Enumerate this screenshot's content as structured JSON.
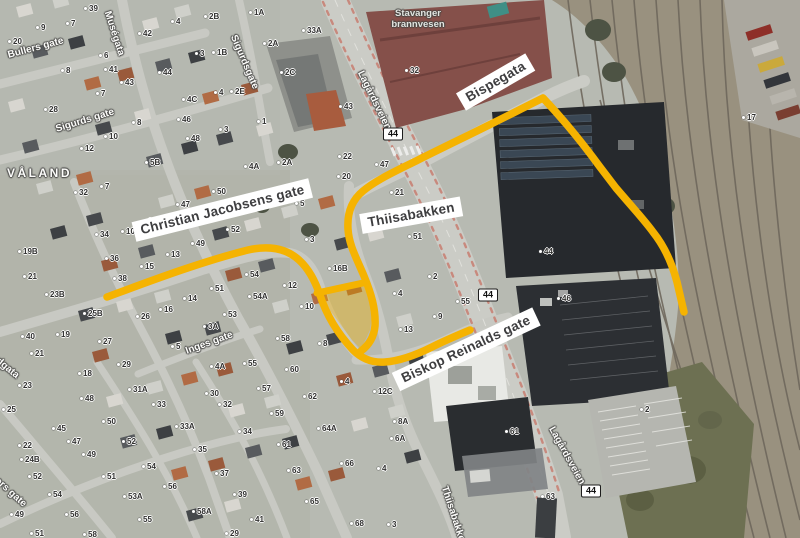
{
  "map": {
    "route_highlight_color": "#F5B301",
    "poi": {
      "line1": "Stavanger",
      "line2": "brannvesen"
    },
    "annotation_boxes": [
      {
        "text": "Christian Jacobsens gate",
        "x": 134,
        "y": 222,
        "rot": -14
      },
      {
        "text": "Thiisabakken",
        "x": 361,
        "y": 214,
        "rot": -10
      },
      {
        "text": "Bispegata",
        "x": 461,
        "y": 92,
        "rot": -30
      },
      {
        "text": "Biskop Reinalds gate",
        "x": 396,
        "y": 372,
        "rot": -25
      }
    ],
    "road_number_badges": [
      {
        "label": "44",
        "x": 393,
        "y": 134
      },
      {
        "label": "44",
        "x": 488,
        "y": 295
      },
      {
        "label": "44",
        "x": 591,
        "y": 491
      }
    ],
    "street_labels": [
      {
        "text": "Bullers gate",
        "x": 8,
        "y": 50,
        "rot": -15,
        "size": 10
      },
      {
        "text": "Muségata",
        "x": 107,
        "y": 6,
        "rot": 72,
        "size": 10
      },
      {
        "text": "Sigurdsgate",
        "x": 233,
        "y": 30,
        "rot": 67,
        "size": 10
      },
      {
        "text": "Sigurds gate",
        "x": 56,
        "y": 124,
        "rot": -17,
        "size": 10
      },
      {
        "text": "VÅLAND",
        "x": 7,
        "y": 166,
        "rot": 0,
        "size": 12,
        "spacing": 2.5
      },
      {
        "text": "Lagårdsveien",
        "x": 360,
        "y": 66,
        "rot": 64,
        "size": 10
      },
      {
        "text": "Inges gate",
        "x": 186,
        "y": 346,
        "rot": -20,
        "size": 10
      },
      {
        "text": "Thiisabakken",
        "x": 444,
        "y": 481,
        "rot": 72,
        "size": 10
      },
      {
        "text": "Lagårdsveien",
        "x": 551,
        "y": 422,
        "rot": 61,
        "size": 10
      },
      {
        "text": "rdgata",
        "x": -6,
        "y": 352,
        "rot": 39,
        "size": 10
      },
      {
        "text": "ters gate",
        "x": -6,
        "y": 472,
        "rot": 42,
        "size": 10
      }
    ],
    "house_numbers": [
      {
        "n": "39",
        "x": 84,
        "y": 5
      },
      {
        "n": "9",
        "x": 36,
        "y": 24
      },
      {
        "n": "7",
        "x": 66,
        "y": 20
      },
      {
        "n": "20",
        "x": 8,
        "y": 38
      },
      {
        "n": "2B",
        "x": 204,
        "y": 13
      },
      {
        "n": "1A",
        "x": 249,
        "y": 9
      },
      {
        "n": "2A",
        "x": 263,
        "y": 40
      },
      {
        "n": "42",
        "x": 138,
        "y": 30
      },
      {
        "n": "4",
        "x": 171,
        "y": 18
      },
      {
        "n": "3",
        "x": 195,
        "y": 50
      },
      {
        "n": "1B",
        "x": 212,
        "y": 49
      },
      {
        "n": "6",
        "x": 99,
        "y": 52
      },
      {
        "n": "8",
        "x": 61,
        "y": 67
      },
      {
        "n": "41",
        "x": 104,
        "y": 66
      },
      {
        "n": "44",
        "x": 158,
        "y": 69
      },
      {
        "n": "43",
        "x": 120,
        "y": 79
      },
      {
        "n": "7",
        "x": 96,
        "y": 90
      },
      {
        "n": "4",
        "x": 214,
        "y": 89
      },
      {
        "n": "2E",
        "x": 230,
        "y": 88
      },
      {
        "n": "4C",
        "x": 182,
        "y": 96
      },
      {
        "n": "28",
        "x": 44,
        "y": 106
      },
      {
        "n": "46",
        "x": 177,
        "y": 116
      },
      {
        "n": "1",
        "x": 257,
        "y": 118
      },
      {
        "n": "8",
        "x": 132,
        "y": 119
      },
      {
        "n": "3",
        "x": 219,
        "y": 126
      },
      {
        "n": "10",
        "x": 104,
        "y": 133
      },
      {
        "n": "48",
        "x": 186,
        "y": 135
      },
      {
        "n": "12",
        "x": 80,
        "y": 145
      },
      {
        "n": "5B",
        "x": 145,
        "y": 159
      },
      {
        "n": "4A",
        "x": 244,
        "y": 163
      },
      {
        "n": "33A",
        "x": 302,
        "y": 27
      },
      {
        "n": "2C",
        "x": 280,
        "y": 69
      },
      {
        "n": "32",
        "x": 405,
        "y": 67
      },
      {
        "n": "43",
        "x": 339,
        "y": 103
      },
      {
        "n": "22",
        "x": 338,
        "y": 153
      },
      {
        "n": "2A",
        "x": 277,
        "y": 159
      },
      {
        "n": "47",
        "x": 375,
        "y": 161
      },
      {
        "n": "20",
        "x": 337,
        "y": 173
      },
      {
        "n": "17",
        "x": 742,
        "y": 114
      },
      {
        "n": "32",
        "x": 74,
        "y": 189
      },
      {
        "n": "7",
        "x": 100,
        "y": 183
      },
      {
        "n": "50",
        "x": 212,
        "y": 188
      },
      {
        "n": "47",
        "x": 176,
        "y": 201
      },
      {
        "n": "8",
        "x": 143,
        "y": 218
      },
      {
        "n": "34",
        "x": 95,
        "y": 231
      },
      {
        "n": "10",
        "x": 121,
        "y": 228
      },
      {
        "n": "52",
        "x": 226,
        "y": 226
      },
      {
        "n": "49",
        "x": 191,
        "y": 240
      },
      {
        "n": "19B",
        "x": 18,
        "y": 248
      },
      {
        "n": "36",
        "x": 105,
        "y": 255
      },
      {
        "n": "13",
        "x": 166,
        "y": 251
      },
      {
        "n": "15",
        "x": 140,
        "y": 263
      },
      {
        "n": "21",
        "x": 23,
        "y": 273
      },
      {
        "n": "38",
        "x": 113,
        "y": 275
      },
      {
        "n": "54",
        "x": 245,
        "y": 271
      },
      {
        "n": "23B",
        "x": 45,
        "y": 291
      },
      {
        "n": "51",
        "x": 210,
        "y": 285
      },
      {
        "n": "54A",
        "x": 248,
        "y": 293
      },
      {
        "n": "14",
        "x": 183,
        "y": 295
      },
      {
        "n": "25B",
        "x": 83,
        "y": 310
      },
      {
        "n": "26",
        "x": 136,
        "y": 313
      },
      {
        "n": "16",
        "x": 159,
        "y": 306
      },
      {
        "n": "53",
        "x": 223,
        "y": 311
      },
      {
        "n": "3A",
        "x": 203,
        "y": 323
      },
      {
        "n": "40",
        "x": 21,
        "y": 333
      },
      {
        "n": "19",
        "x": 56,
        "y": 331
      },
      {
        "n": "27",
        "x": 98,
        "y": 338
      },
      {
        "n": "21",
        "x": 30,
        "y": 350
      },
      {
        "n": "5",
        "x": 171,
        "y": 343
      },
      {
        "n": "5",
        "x": 295,
        "y": 200
      },
      {
        "n": "21",
        "x": 390,
        "y": 189
      },
      {
        "n": "3",
        "x": 305,
        "y": 236
      },
      {
        "n": "51",
        "x": 408,
        "y": 233
      },
      {
        "n": "16B",
        "x": 328,
        "y": 265
      },
      {
        "n": "2",
        "x": 428,
        "y": 273
      },
      {
        "n": "12",
        "x": 283,
        "y": 282
      },
      {
        "n": "4",
        "x": 393,
        "y": 290
      },
      {
        "n": "10",
        "x": 300,
        "y": 303
      },
      {
        "n": "55",
        "x": 456,
        "y": 298
      },
      {
        "n": "9",
        "x": 433,
        "y": 313
      },
      {
        "n": "13",
        "x": 399,
        "y": 326
      },
      {
        "n": "58",
        "x": 276,
        "y": 335
      },
      {
        "n": "8",
        "x": 318,
        "y": 340
      },
      {
        "n": "44",
        "x": 539,
        "y": 248
      },
      {
        "n": "46",
        "x": 557,
        "y": 295
      },
      {
        "n": "23",
        "x": 18,
        "y": 382
      },
      {
        "n": "18",
        "x": 78,
        "y": 370
      },
      {
        "n": "29",
        "x": 117,
        "y": 361
      },
      {
        "n": "31A",
        "x": 128,
        "y": 386
      },
      {
        "n": "4A",
        "x": 210,
        "y": 363
      },
      {
        "n": "55",
        "x": 243,
        "y": 360
      },
      {
        "n": "25",
        "x": 2,
        "y": 406
      },
      {
        "n": "48",
        "x": 80,
        "y": 395
      },
      {
        "n": "33",
        "x": 152,
        "y": 401
      },
      {
        "n": "30",
        "x": 205,
        "y": 390
      },
      {
        "n": "57",
        "x": 257,
        "y": 385
      },
      {
        "n": "32",
        "x": 218,
        "y": 401
      },
      {
        "n": "45",
        "x": 52,
        "y": 425
      },
      {
        "n": "50",
        "x": 102,
        "y": 418
      },
      {
        "n": "33A",
        "x": 175,
        "y": 423
      },
      {
        "n": "34",
        "x": 238,
        "y": 428
      },
      {
        "n": "22",
        "x": 18,
        "y": 442
      },
      {
        "n": "47",
        "x": 67,
        "y": 438
      },
      {
        "n": "52",
        "x": 122,
        "y": 438
      },
      {
        "n": "24B",
        "x": 20,
        "y": 456
      },
      {
        "n": "49",
        "x": 82,
        "y": 451
      },
      {
        "n": "35",
        "x": 193,
        "y": 446
      },
      {
        "n": "54",
        "x": 142,
        "y": 463
      },
      {
        "n": "52",
        "x": 28,
        "y": 473
      },
      {
        "n": "51",
        "x": 102,
        "y": 473
      },
      {
        "n": "37",
        "x": 215,
        "y": 470
      },
      {
        "n": "56",
        "x": 163,
        "y": 483
      },
      {
        "n": "54",
        "x": 48,
        "y": 491
      },
      {
        "n": "53A",
        "x": 123,
        "y": 493
      },
      {
        "n": "39",
        "x": 233,
        "y": 491
      },
      {
        "n": "49",
        "x": 10,
        "y": 511
      },
      {
        "n": "56",
        "x": 65,
        "y": 511
      },
      {
        "n": "55",
        "x": 138,
        "y": 516
      },
      {
        "n": "58A",
        "x": 192,
        "y": 508
      },
      {
        "n": "41",
        "x": 250,
        "y": 516
      },
      {
        "n": "51",
        "x": 30,
        "y": 530
      },
      {
        "n": "58",
        "x": 83,
        "y": 531
      },
      {
        "n": "29",
        "x": 225,
        "y": 530
      },
      {
        "n": "60",
        "x": 285,
        "y": 366
      },
      {
        "n": "4",
        "x": 340,
        "y": 378
      },
      {
        "n": "12C",
        "x": 373,
        "y": 388
      },
      {
        "n": "62",
        "x": 303,
        "y": 393
      },
      {
        "n": "59",
        "x": 270,
        "y": 410
      },
      {
        "n": "8A",
        "x": 393,
        "y": 418
      },
      {
        "n": "64A",
        "x": 317,
        "y": 425
      },
      {
        "n": "61",
        "x": 277,
        "y": 441
      },
      {
        "n": "6A",
        "x": 390,
        "y": 435
      },
      {
        "n": "66",
        "x": 340,
        "y": 460
      },
      {
        "n": "4",
        "x": 377,
        "y": 465
      },
      {
        "n": "63",
        "x": 287,
        "y": 467
      },
      {
        "n": "61",
        "x": 505,
        "y": 428
      },
      {
        "n": "65",
        "x": 305,
        "y": 498
      },
      {
        "n": "68",
        "x": 350,
        "y": 520
      },
      {
        "n": "3",
        "x": 387,
        "y": 521
      },
      {
        "n": "2",
        "x": 640,
        "y": 406
      },
      {
        "n": "63",
        "x": 541,
        "y": 493
      }
    ]
  }
}
